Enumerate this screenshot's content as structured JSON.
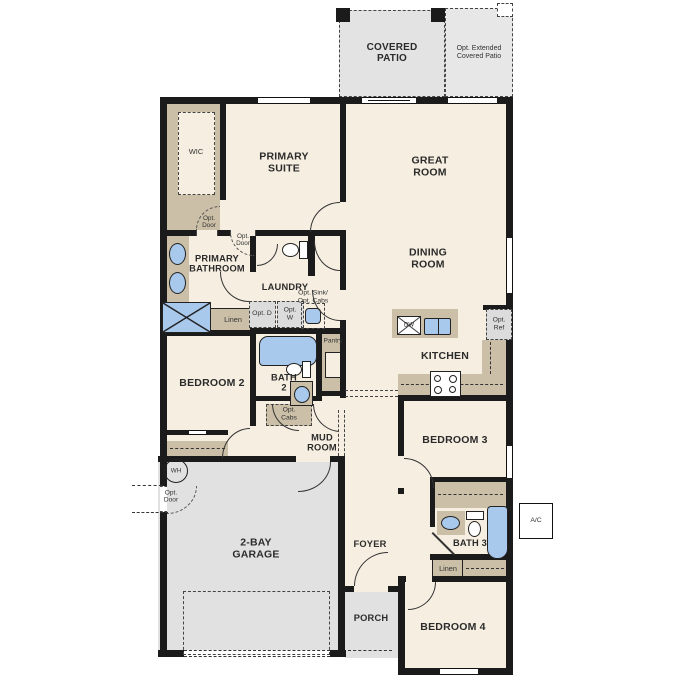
{
  "title": "Single-story floor plan",
  "colors": {
    "floor": "#f6efe1",
    "wall": "#1b1b1b",
    "cabinet_tan": "#cbbfa7",
    "concrete_gray": "#e3e3e3",
    "fixture_blue": "#a9c9ec",
    "opt_gray": "#dcdcdc",
    "text": "#2b2b2b"
  },
  "outdoor": {
    "covered_patio": "COVERED PATIO",
    "opt_extended_patio": "Opt. Extended Covered Patio",
    "porch": "PORCH",
    "ac_unit": "A/C"
  },
  "rooms": {
    "wic": "WIC",
    "primary_suite": "PRIMARY SUITE",
    "great_room": "GREAT ROOM",
    "dining_room": "DINING ROOM",
    "primary_bathroom": "PRIMARY BATHROOM",
    "laundry": "LAUNDRY",
    "kitchen": "KITCHEN",
    "pantry": "Pantry",
    "bedroom_2": "BEDROOM 2",
    "bath_2": "BATH 2",
    "mud_room": "MUD ROOM",
    "garage": "2-BAY GARAGE",
    "foyer": "FOYER",
    "bedroom_3": "BEDROOM 3",
    "bath_3": "BATH 3",
    "bedroom_4": "BEDROOM 4"
  },
  "callouts": {
    "opt_door": "Opt. Door",
    "opt_dryer": "Opt. D",
    "opt_washer": "Opt. W",
    "opt_sink_cabs": "Opt. Sink/ Opt. Cabs",
    "opt_cabs": "Opt. Cabs",
    "opt_ref": "Opt. Ref",
    "linen": "Linen",
    "water_heater": "WH",
    "dishwasher": "DW"
  }
}
